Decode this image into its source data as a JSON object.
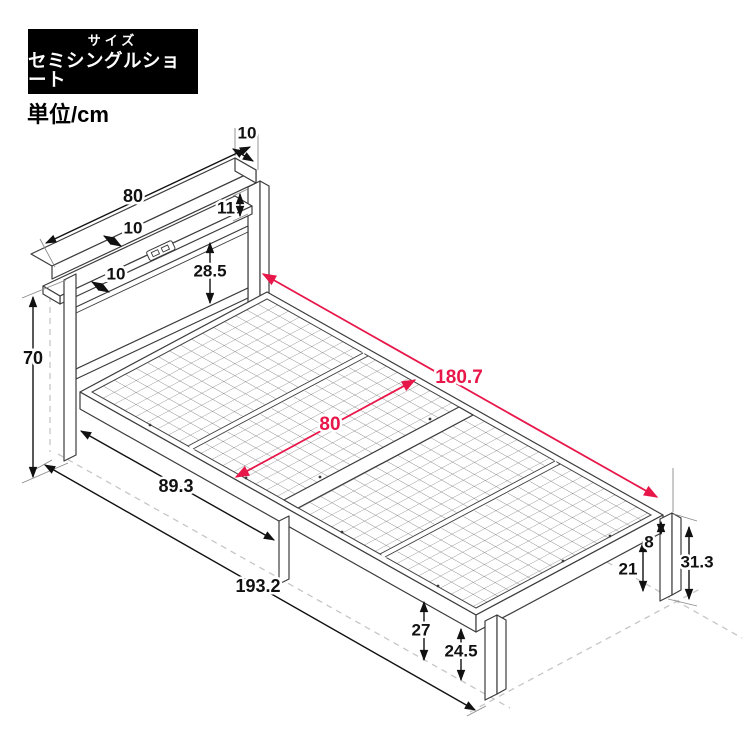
{
  "size_badge": {
    "title": "サイズ",
    "value": "セミシングルショート"
  },
  "unit_label": "単位/cm",
  "diagram": {
    "type": "bed-frame-isometric-dimension-drawing",
    "colors": {
      "outline": "#3c3c3c",
      "dimension": "#111111",
      "accent_red": "#e8174a",
      "guide_dashed": "#c6c6c6",
      "badge_bg": "#000000",
      "badge_text": "#ffffff"
    },
    "dims": {
      "shelf_depth_top": "10",
      "headboard_width": "80",
      "slot_height": "11",
      "shelf_depth_upper": "10",
      "shelf_depth_lower": "10",
      "panel_height": "28.5",
      "headboard_height": "70",
      "head_to_center_leg": "89.3",
      "total_length": "193.2",
      "under_clearance_center": "27",
      "under_clearance_foot": "24.5",
      "under_clearance_side": "21",
      "frame_height": "8",
      "footboard_height": "31.3",
      "inner_length": "180.7",
      "inner_width": "80"
    }
  }
}
